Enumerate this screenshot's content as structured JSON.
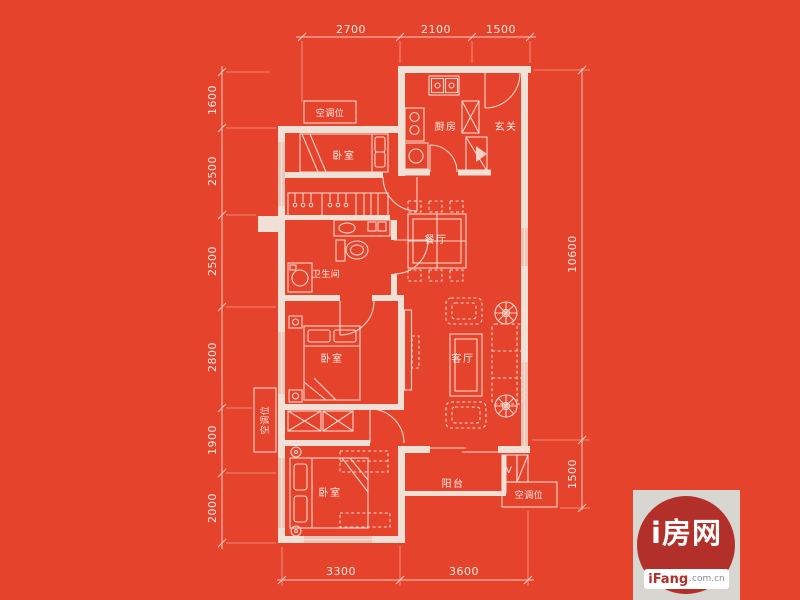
{
  "colors": {
    "background": "#e6432d",
    "line": "#f6e2d7",
    "wall": "#f0e0d6",
    "window": "#e9c6b8",
    "text": "#fdf2ec",
    "logo_panel": "#d8d6d1",
    "logo_circle": "#b23029",
    "logo_domain": "#8d8b88"
  },
  "rooms": {
    "bedroom_top": "卧室",
    "bedroom_middle": "卧室",
    "bedroom_bottom": "卧室",
    "kitchen": "厨房",
    "entry": "玄关",
    "dining": "餐厅",
    "bathroom": "卫生间",
    "living": "客厅",
    "balcony": "阳台",
    "ac_top": "空调位",
    "ac_left": "空调位",
    "ac_bottom": "空调位",
    "vent": "V"
  },
  "dimensions": {
    "top": [
      "2700",
      "2100",
      "1500"
    ],
    "left": [
      "1600",
      "2500",
      "2500",
      "2800",
      "1900",
      "2000"
    ],
    "right": [
      "10600",
      "1500"
    ],
    "bottom": [
      "3300",
      "3600"
    ]
  },
  "watermark": {
    "brand": "i房网",
    "site": "iFang",
    "domain": ".com.cn"
  }
}
